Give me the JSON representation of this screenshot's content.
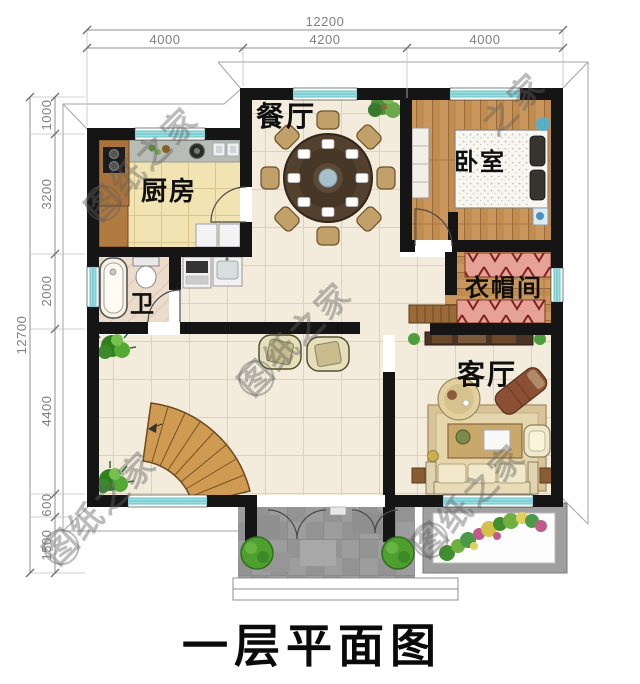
{
  "title": "一层平面图",
  "watermark": {
    "text": "图纸之家",
    "partial_text": "之家"
  },
  "dimensions": {
    "top": {
      "total": "12200",
      "segments": [
        "4000",
        "4200",
        "4000"
      ]
    },
    "left": {
      "total": "12700",
      "segments": [
        "1000",
        "3200",
        "2000",
        "4400",
        "600",
        "1500"
      ]
    }
  },
  "rooms": {
    "dining": "餐厅",
    "kitchen": "厨房",
    "bedroom": "卧室",
    "bath": "卫",
    "cloak": "衣帽间",
    "living": "客厅"
  },
  "colors": {
    "wall": "#151515",
    "window_accent": "#7fd0d4",
    "wood_floor": "#c18c50",
    "tile_floor": "#f3ecdc",
    "porch": "#9d9d9d",
    "dimension_text": "#7f7f7f"
  }
}
